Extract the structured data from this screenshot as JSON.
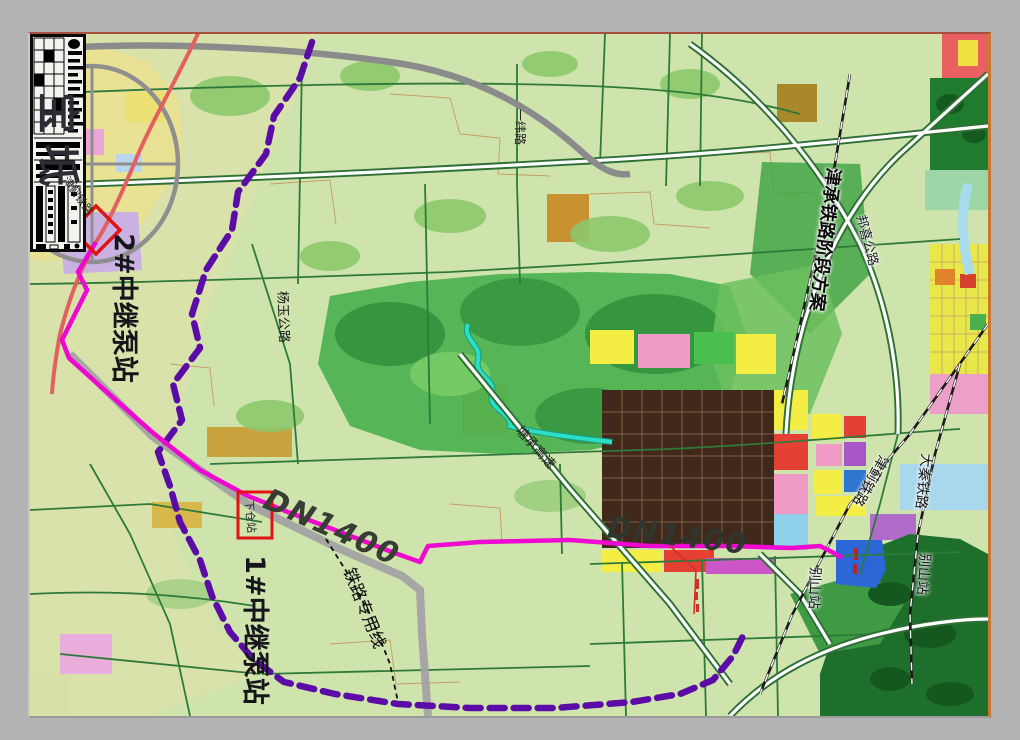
{
  "colors": {
    "frame": "#b3b3b3",
    "map_background": "#cfe3ad",
    "pipeline": "#ee08d0",
    "boundary": "#5b0ca6",
    "marker": "#e01414",
    "railway_red": "#e26060"
  },
  "map": {
    "region_name": "宝坻",
    "pump_station_2": "2#中继泵站",
    "pump_station_1": "1#中继泵站",
    "pipeline_label_left": "DN1400",
    "pipeline_label_right": "DN1400",
    "railway_spur": "铁路专用线",
    "jincheng_railway_plan": "津承铁路阶段方案",
    "yangyu_highway": "杨玉公路",
    "jinji_railway_west": "津蓟铁路",
    "jinji_railway_east": "津蓟铁路",
    "daqin_railway": "大秦铁路",
    "bieshan_station_west": "别山站",
    "bieshan_station_east": "别山站",
    "bangxi_highway": "邦喜公路",
    "tangcheng_expressway": "塘承高速",
    "yiwei_road": "一纬路",
    "xiacang_station": "下仓站"
  }
}
